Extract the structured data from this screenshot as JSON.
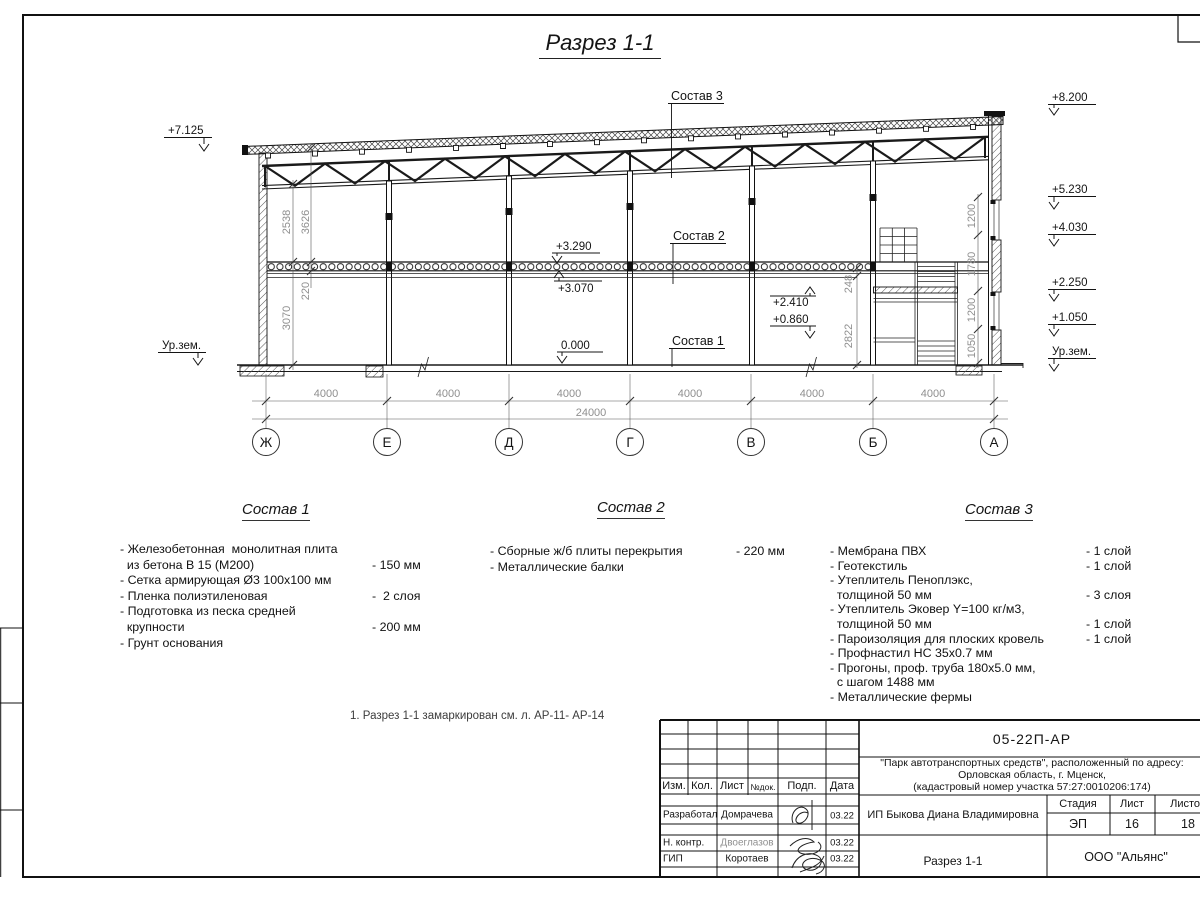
{
  "sheet": {
    "title": "Разрез 1-1",
    "note": "1. Разрез 1-1 замаркирован см. л. АР-11- АР-14"
  },
  "drawing": {
    "axes": [
      "Ж",
      "Е",
      "Д",
      "Г",
      "В",
      "Б",
      "А"
    ],
    "bay_dims": [
      "4000",
      "4000",
      "4000",
      "4000",
      "4000",
      "4000"
    ],
    "total_dim": "24000",
    "elev": {
      "left_roof": "+7.125",
      "ground_left": "Ур.зем.",
      "right": [
        "+8.200",
        "+5.230",
        "+4.030",
        "+2.250",
        "+1.050",
        "Ур.зем."
      ],
      "slab_top": "+3.290",
      "slab_bottom": "+3.070",
      "stair_upper": "+2.410",
      "stair_lower": "+0.860",
      "zero": "0.000"
    },
    "vdims": {
      "left": [
        "2538",
        "3626",
        "220",
        "3070"
      ],
      "right": [
        "1200",
        "1780",
        "1200",
        "1050"
      ],
      "stair": [
        "248",
        "2822"
      ]
    },
    "callouts": [
      "Состав 1",
      "Состав 2",
      "Состав 3"
    ]
  },
  "compositions": [
    {
      "title": "Состав 1",
      "rows": [
        {
          "l": "- Железобетонная  монолитная плита",
          "r": ""
        },
        {
          "l": "  из бетона В 15 (М200)",
          "r": "- 150 мм"
        },
        {
          "l": "- Сетка армирующая Ø3 100х100 мм",
          "r": ""
        },
        {
          "l": "- Пленка полиэтиленовая",
          "r": "-  2 слоя"
        },
        {
          "l": "- Подготовка из песка средней",
          "r": ""
        },
        {
          "l": "  крупности",
          "r": "- 200 мм"
        },
        {
          "l": "- Грунт основания",
          "r": ""
        }
      ]
    },
    {
      "title": "Состав 2",
      "rows": [
        {
          "l": "- Сборные ж/б плиты перекрытия",
          "r": "- 220 мм"
        },
        {
          "l": "- Металлические балки",
          "r": ""
        }
      ]
    },
    {
      "title": "Состав 3",
      "rows": [
        {
          "l": "- Мембрана ПВХ",
          "r": "- 1 слой"
        },
        {
          "l": "- Геотекстиль",
          "r": "- 1 слой"
        },
        {
          "l": "- Утеплитель Пеноплэкс,",
          "r": ""
        },
        {
          "l": "  толщиной 50 мм",
          "r": "- 3 слоя"
        },
        {
          "l": "- Утеплитель Эковер Y=100 кг/м3,",
          "r": ""
        },
        {
          "l": "  толщиной 50 мм",
          "r": "- 1 слой"
        },
        {
          "l": "- Пароизоляция для плоских кровель",
          "r": "- 1 слой"
        },
        {
          "l": "- Профнастил НС 35х0.7 мм",
          "r": ""
        },
        {
          "l": "- Прогоны, проф. труба 180х5.0 мм,",
          "r": ""
        },
        {
          "l": "  с шагом 1488 мм",
          "r": ""
        },
        {
          "l": "- Металлические фермы",
          "r": ""
        }
      ]
    }
  ],
  "titleblock": {
    "doc_code": "05-22П-АР",
    "project": [
      "\"Парк автотранспортных средств\",  расположенный по адресу:",
      "Орловская область, г. Мценск,",
      "(кадастровый номер участка 57:27:0010206:174)"
    ],
    "header_cols": [
      "Изм.",
      "Кол.",
      "Лист",
      "№док.",
      "Подп.",
      "Дата"
    ],
    "signers": [
      {
        "role": "Разработал",
        "name": "Домрачева",
        "date": "03.22"
      },
      {
        "role": "Н. контр.",
        "name": "Двоеглазов",
        "date": "03.22"
      },
      {
        "role": "ГИП",
        "name": "Коротаев",
        "date": "03.22"
      }
    ],
    "client": "ИП Быкова Диана Владимировна",
    "stage_label": "Стадия",
    "sheet_label": "Лист",
    "sheets_label": "Листов",
    "stage": "ЭП",
    "sheet": "16",
    "sheets": "18",
    "drawing_name": "Разрез 1-1",
    "company": "ООО \"Альянс\""
  }
}
